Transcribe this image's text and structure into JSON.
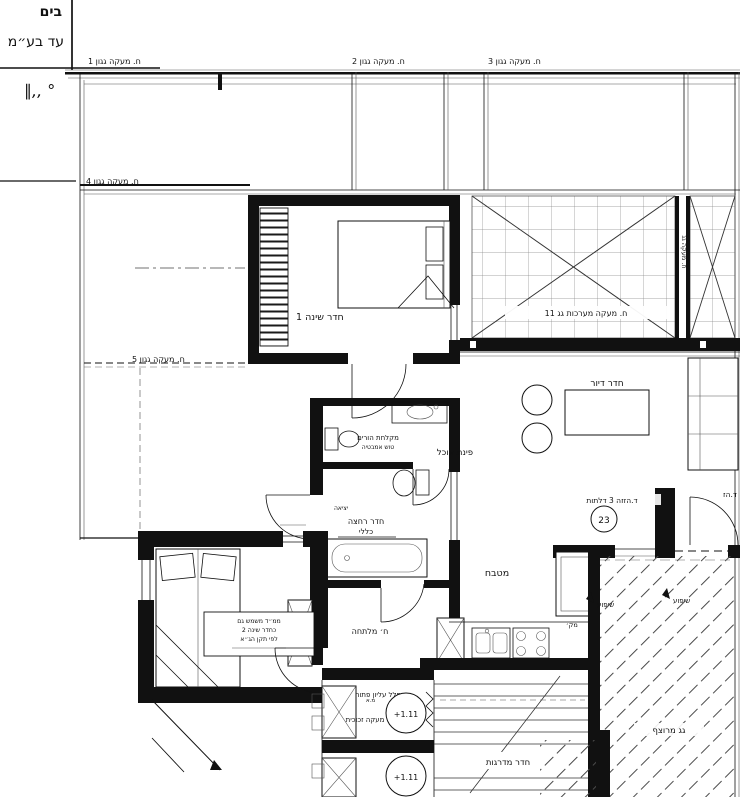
{
  "titleblock": {
    "line1": "בים",
    "line2": "עד בע״מ",
    "scale_mark": "∥,, °"
  },
  "labels": {
    "p1": "ח. מעקה גגון 1",
    "p2": "ח. מעקה גגון 2",
    "p3": "ח. מעקה גגון 3",
    "p4": "ח. מעקה גגון 4",
    "p5": "ח. מעקה גגון 5",
    "tech": "ח. מעקה מערכות גג 11",
    "tech_side": "ח. מעקה גג",
    "bedroom1": "חדר שינה 1",
    "shower1": "מקלחת הורים",
    "shower2": "טוש אמבטיה",
    "dining": "פינת אוכל",
    "living": "חדר דיור",
    "slide": "ד.הזזה 3 דלתות",
    "tag23": "23",
    "door_cut": "ד.הז",
    "niche": "יציאה",
    "bath1": "חדר רחצה",
    "bath2": "כללי",
    "kitchen": "מטבח",
    "fridge": "מק׳",
    "mamad1": "ממ״ד משמש גם",
    "mamad2": "כחדר שינה 2",
    "mamad3": "לפי תקן הג״א",
    "dressing": "ח׳ מלתחה",
    "void1": "חלל עליון פתוח",
    "void2": "מעקה זכוכית",
    "lvl1": "+1.11",
    "lvl2": "+1.11",
    "stairs": "חדר מדרגות",
    "slope1": "שיפוע",
    "slope2": "שיפוע",
    "roof": "גג מרוצף",
    "ac": "מ.א"
  },
  "colors": {
    "ink": "#111111",
    "paper": "#ffffff",
    "line_gray": "#666666"
  }
}
